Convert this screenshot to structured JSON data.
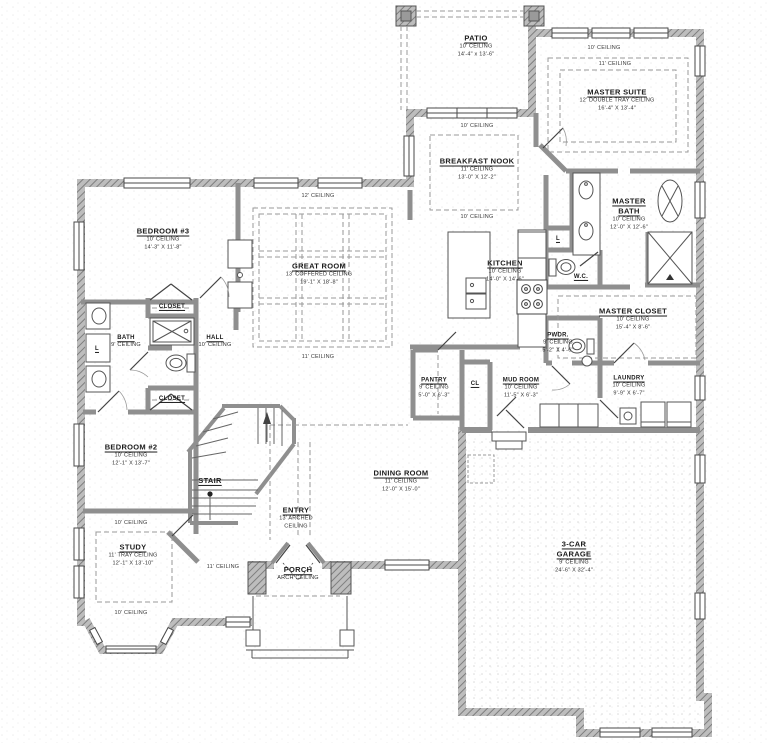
{
  "rooms": {
    "patio": {
      "name": "PATIO",
      "ceiling": "10' CEILING",
      "dims": "14'-4\" x 13'-6\""
    },
    "master_suite": {
      "name": "MASTER SUITE",
      "ceiling": "12' DOUBLE TRAY CEILING",
      "dims": "16'-4\" X 13'-4\""
    },
    "master_bath": {
      "name": "MASTER BATH",
      "ceiling": "10' CEILING",
      "dims": "12'-0\" X 12'-6\""
    },
    "wc": {
      "name": "W.C."
    },
    "master_closet": {
      "name": "MASTER CLOSET",
      "ceiling": "10' CEILING",
      "dims": "15'-4\" X 8'-6\""
    },
    "breakfast_nook": {
      "name": "BREAKFAST NOOK",
      "ceiling": "11' CEILING",
      "dims": "13'-0\" X 12'-2\""
    },
    "kitchen": {
      "name": "KITCHEN",
      "ceiling": "10' CEILING",
      "dims": "14'-0\" X 14'-6\""
    },
    "great_room": {
      "name": "GREAT ROOM",
      "ceiling": "13' COFFERED CEILING",
      "dims": "19'-1\" X 18'-8\""
    },
    "bedroom3": {
      "name": "BEDROOM #3",
      "ceiling": "10' CEILING",
      "dims": "14'-3\" X 11'-8\""
    },
    "bath": {
      "name": "BATH",
      "ceiling": "9' CEILING"
    },
    "hall": {
      "name": "HALL",
      "ceiling": "10' CEILING"
    },
    "closet_a": {
      "name": "CLOSET"
    },
    "closet_b": {
      "name": "CLOSET"
    },
    "bedroom2": {
      "name": "BEDROOM #2",
      "ceiling": "10' CEILING",
      "dims": "12'-1\" X 13'-7\""
    },
    "stair": {
      "name": "STAIR"
    },
    "study": {
      "name": "STUDY",
      "ceiling": "11' TRAY CEILING",
      "dims": "12'-1\" X 13'-10\""
    },
    "dining": {
      "name": "DINING ROOM",
      "ceiling": "11' CEILING",
      "dims": "12'-0\" X 15'-0\""
    },
    "entry": {
      "name": "ENTRY",
      "ceiling": "13' ARCHED CEILING"
    },
    "porch": {
      "name": "PORCH",
      "ceiling": "ARCH CEILING"
    },
    "garage": {
      "name": "3-CAR GARAGE",
      "ceiling": "9' CEILING",
      "dims": "24'-6\" X 32'-4\""
    },
    "pwdr": {
      "name": "PWDR.",
      "ceiling": "9' CEILING",
      "dims": "5'-2\" X 4'-6\""
    },
    "pantry": {
      "name": "PANTRY",
      "ceiling": "9' CEILING",
      "dims": "5'-0\" X 6'-3\""
    },
    "mud_room": {
      "name": "MUD ROOM",
      "ceiling": "10' CEILING",
      "dims": "11'-5\" X 6'-3\""
    },
    "laundry": {
      "name": "LAUNDRY",
      "ceiling": "10' CEILING",
      "dims": "9'-9\" X 6'-7\""
    },
    "cl": {
      "name": "CL"
    },
    "linen_bath": {
      "name": "L"
    },
    "linen_master": {
      "name": "L"
    }
  },
  "ceiling_notes": [
    {
      "text": "12' CEILING"
    },
    {
      "text": "11' CEILING"
    },
    {
      "text": "10' CEILING"
    },
    {
      "text": "10' CEILING"
    },
    {
      "text": "10' CEILING"
    },
    {
      "text": "11' CEILING"
    },
    {
      "text": "10' CEILING"
    },
    {
      "text": "10' CEILING"
    },
    {
      "text": "11' CEILING"
    }
  ],
  "colors": {
    "wall_gray": "#8f8f8f",
    "hatch_light": "#c9c9c9",
    "line_dark": "#4a4a4a",
    "dash_gray": "#9a9a9a"
  }
}
